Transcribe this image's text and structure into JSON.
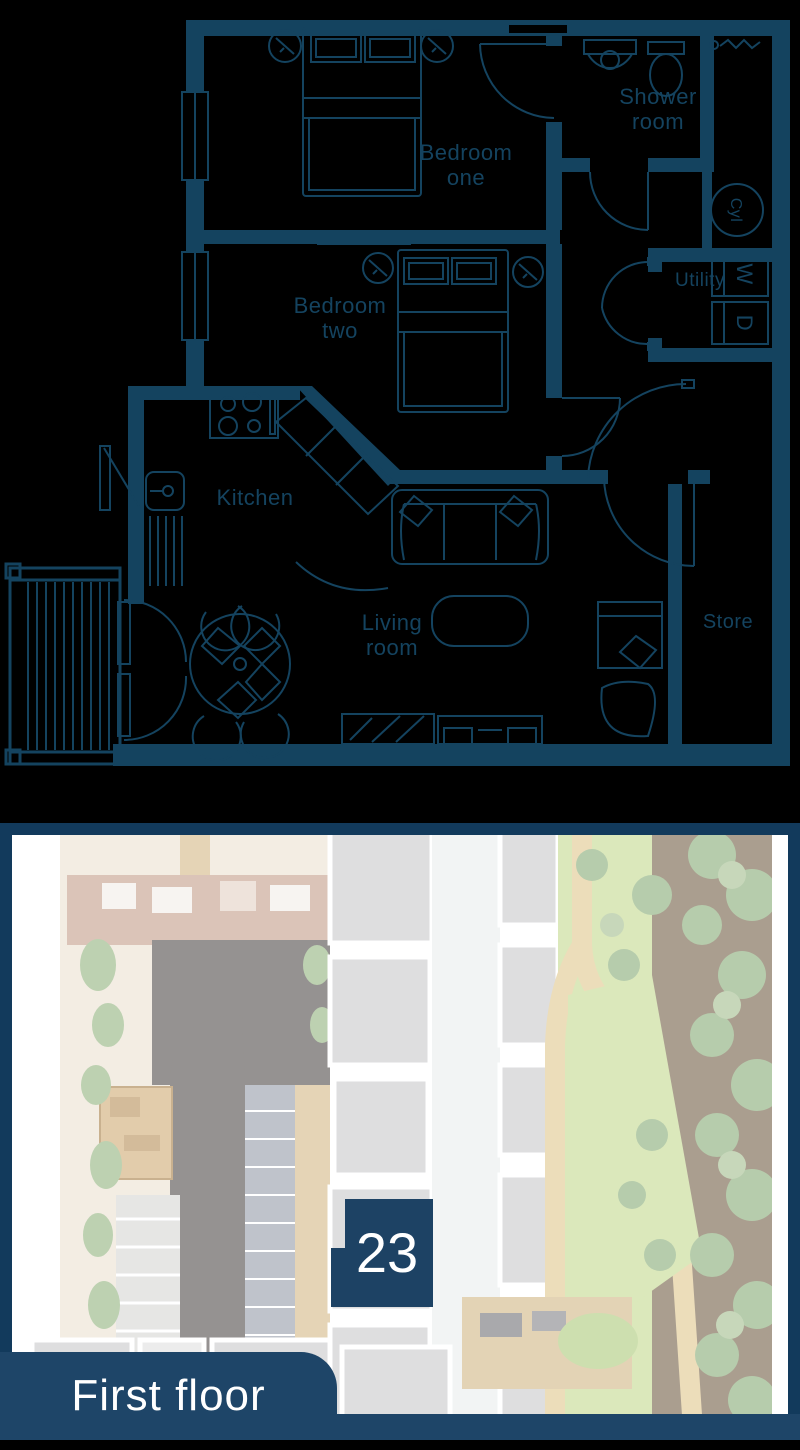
{
  "colors": {
    "ink": "#14435f",
    "frame_navy": "#123a5c",
    "marker_navy": "#1d4264",
    "tab_navy": "#1e4568",
    "label_text": "#ffffff"
  },
  "floorplan": {
    "rooms": {
      "bedroom_one": {
        "line1": "Bedroom",
        "line2": "one"
      },
      "bedroom_two": {
        "line1": "Bedroom",
        "line2": "two"
      },
      "shower_room": {
        "line1": "Shower",
        "line2": "room"
      },
      "utility": {
        "label": "Utility"
      },
      "kitchen": {
        "label": "Kitchen"
      },
      "living_room": {
        "line1": "Living",
        "line2": "room"
      },
      "store": {
        "label": "Store"
      }
    },
    "symbols": {
      "cylinder": "Cyl",
      "washer": "W",
      "dryer": "D"
    }
  },
  "siteplan": {
    "plot_marker": "23",
    "floor_tab": "First floor"
  }
}
